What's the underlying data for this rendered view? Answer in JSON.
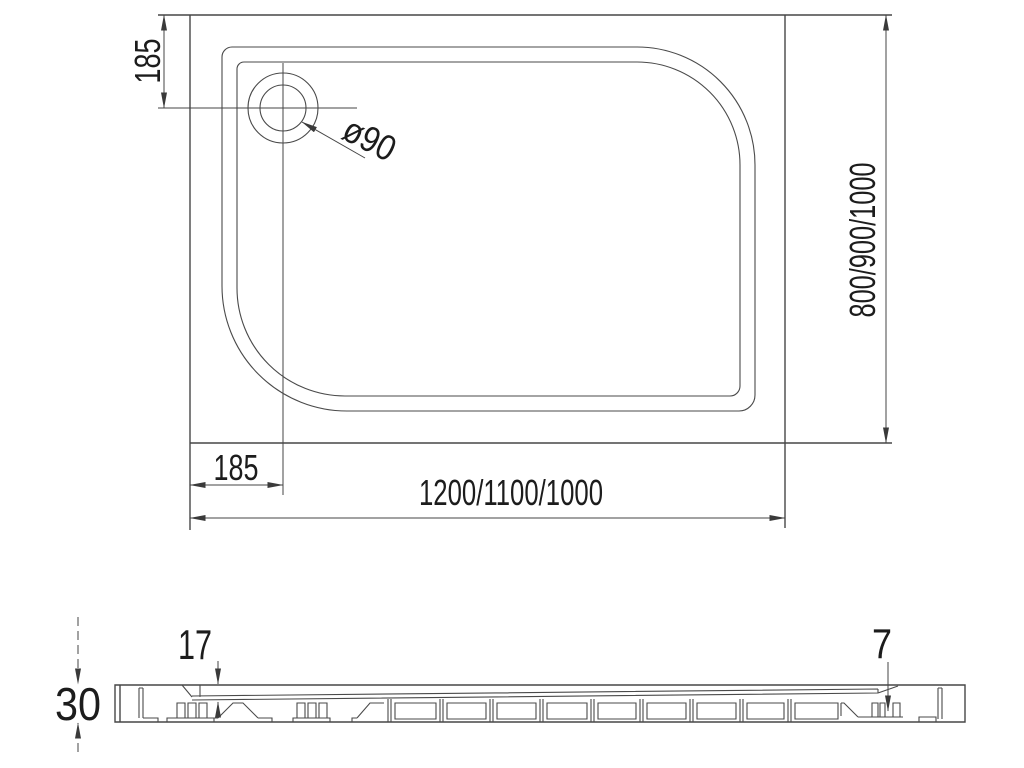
{
  "plan_view": {
    "drain_offset_vertical": "185",
    "drain_diameter": "ø90",
    "depth_variants": "800/900/1000",
    "drain_offset_horizontal": "185",
    "width_variants": "1200/1100/1000"
  },
  "section_view": {
    "overall_height": "30",
    "inner_thickness": "17",
    "edge_thickness": "7"
  },
  "colors": {
    "line": "#4a4a4a",
    "text": "#1c1c1c",
    "background": "#ffffff"
  }
}
